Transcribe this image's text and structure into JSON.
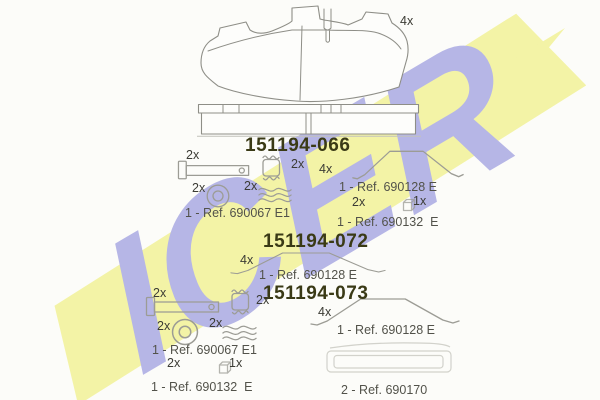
{
  "watermark": {
    "brand": "ICER"
  },
  "colors": {
    "band": "#f3f3a6",
    "letters": "#b6b6e6",
    "partnum": "#3a3a16",
    "ref": "#52524a",
    "qty": "#3b3b34"
  },
  "top": {
    "pad_qty": "4x"
  },
  "s066": {
    "part_number": "151194-066",
    "pin_qty": "2x",
    "washer_qty": "2x",
    "spring_qty": "2x",
    "clip_qty": "2x",
    "kit_ref": "1 - Ref. 690067 E1",
    "wire_qty": "4x",
    "wire_ref": "1 - Ref. 690128 E",
    "bolt_qty": "2x",
    "box_qty": "1x",
    "box_ref": "1 - Ref. 690132  E"
  },
  "s072": {
    "part_number": "151194-072",
    "wire_qty": "4x",
    "wire_ref": "1 - Ref. 690128 E"
  },
  "s073": {
    "part_number": "151194-073",
    "pin_qty": "2x",
    "washer_qty": "2x",
    "spring_qty": "2x",
    "clip_qty": "2x",
    "kit_ref": "1 - Ref. 690067 E1",
    "bolt_qty": "2x",
    "box_qty": "1x",
    "box_ref": "1 - Ref. 690132  E",
    "wire_qty": "4x",
    "wire_ref": "1 - Ref. 690128 E",
    "plate_ref": "2 - Ref. 690170"
  }
}
